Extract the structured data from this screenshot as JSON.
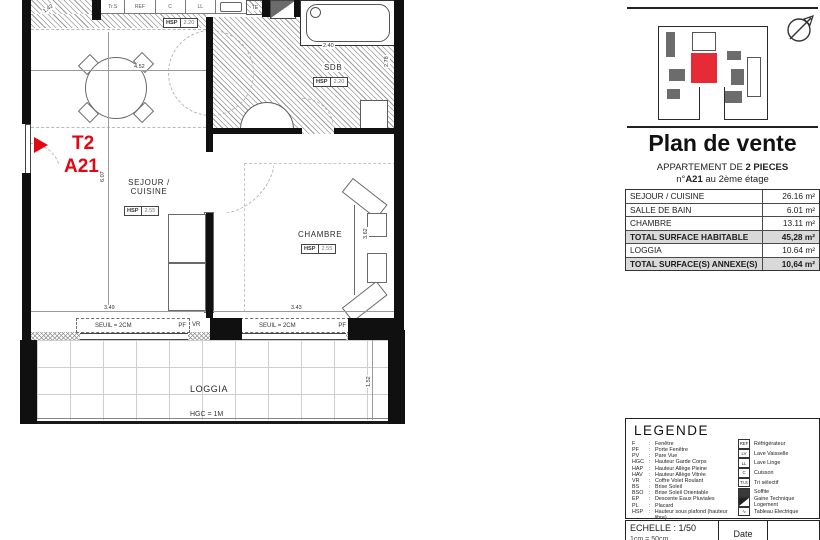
{
  "colors": {
    "accent": "#e30613",
    "totalbg": "#d9d9d9",
    "wall": "#101010"
  },
  "plan": {
    "unit_type": "T2",
    "unit_code": "A21",
    "rooms": {
      "sejour1": "SEJOUR /",
      "sejour2": "CUISINE",
      "chambre": "CHAMBRE",
      "sdb": "SDB",
      "loggia": "LOGGIA"
    },
    "hgc": "HGC = 1M",
    "hsp": {
      "abbr": "HSP",
      "sejour": "2.55",
      "chambre": "2.55",
      "sdb": "2.20",
      "kitchen": "2.20"
    },
    "windows": {
      "seuil": "SEUIL = 2CM",
      "pf": "PF",
      "vr": "VR"
    },
    "kitchen_cells": [
      "Tr.S",
      "REF",
      "C",
      "LL"
    ],
    "te": "TE",
    "dims": {
      "top_left": "1.42",
      "sejour_width": "4.52",
      "sejour_height": "6.07",
      "window_left": "3.49",
      "window_right": "3.43",
      "chambre_height": "3.62",
      "loggia_depth": "1.52",
      "sdb_width": "2.40",
      "sdb_height": "2.78"
    }
  },
  "panel": {
    "title": "Plan de vente",
    "subtitle": {
      "prefix": "APPARTEMENT DE ",
      "pieces": "2 PIECES",
      "num_prefix": "n°",
      "unit": "A21",
      "suffix": " au 2ème étage"
    },
    "surface_table": {
      "rows": [
        {
          "label": "SEJOUR / CUISINE",
          "value": "26.16",
          "unit": "m²"
        },
        {
          "label": "SALLE DE BAIN",
          "value": "6.01",
          "unit": "m²"
        },
        {
          "label": "CHAMBRE",
          "value": "13.11",
          "unit": "m²"
        },
        {
          "label": "TOTAL SURFACE HABITABLE",
          "value": "45,28",
          "unit": "m²"
        },
        {
          "label": "LOGGIA",
          "value": "10.64",
          "unit": "m²"
        },
        {
          "label": "TOTAL SURFACE(S) ANNEXE(S)",
          "value": "10,64",
          "unit": "m²"
        }
      ]
    },
    "legend": {
      "title": "LEGENDE",
      "sep": ":",
      "abbreviations": [
        {
          "abbr": "F",
          "desc": "Fenêtre"
        },
        {
          "abbr": "PF",
          "desc": "Porte Fenêtre"
        },
        {
          "abbr": "PV",
          "desc": "Pare Vue"
        },
        {
          "abbr": "HGC",
          "desc": "Hauteur Garde Corps"
        },
        {
          "abbr": "HAP",
          "desc": "Hauteur Allège Pleine"
        },
        {
          "abbr": "HAV",
          "desc": "Hauteur Allège Vitrée"
        },
        {
          "abbr": "VR",
          "desc": "Coffre Volet Roulant"
        },
        {
          "abbr": "BS",
          "desc": "Brise Soleil"
        },
        {
          "abbr": "BSO",
          "desc": "Brise Soleil Orientable"
        },
        {
          "abbr": "EP",
          "desc": "Descente Eaux Pluviales"
        },
        {
          "abbr": "PL",
          "desc": "Placard"
        },
        {
          "abbr": "HSP",
          "desc": "Hauteur sous plafond (hauteur libre)"
        }
      ],
      "icons": [
        {
          "glyph": "REF",
          "label": "Réfrigérateur"
        },
        {
          "glyph": "LV",
          "label": "Lave Vaisselle"
        },
        {
          "glyph": "LL",
          "label": "Lave Linge"
        },
        {
          "glyph": "C",
          "label": "Cuisson"
        },
        {
          "glyph": "Tr.S",
          "label": "Tri sélectif"
        },
        {
          "glyph": "",
          "label": "Soffite"
        },
        {
          "glyph": "",
          "label": "Gaine Technique Logement"
        },
        {
          "glyph": "∿",
          "label": "Tableau Electrique"
        }
      ]
    },
    "titleblock": {
      "echelle": "ECHELLE : 1/50",
      "echelle_sub": "1cm = 50cm",
      "date_label": "Date"
    }
  }
}
